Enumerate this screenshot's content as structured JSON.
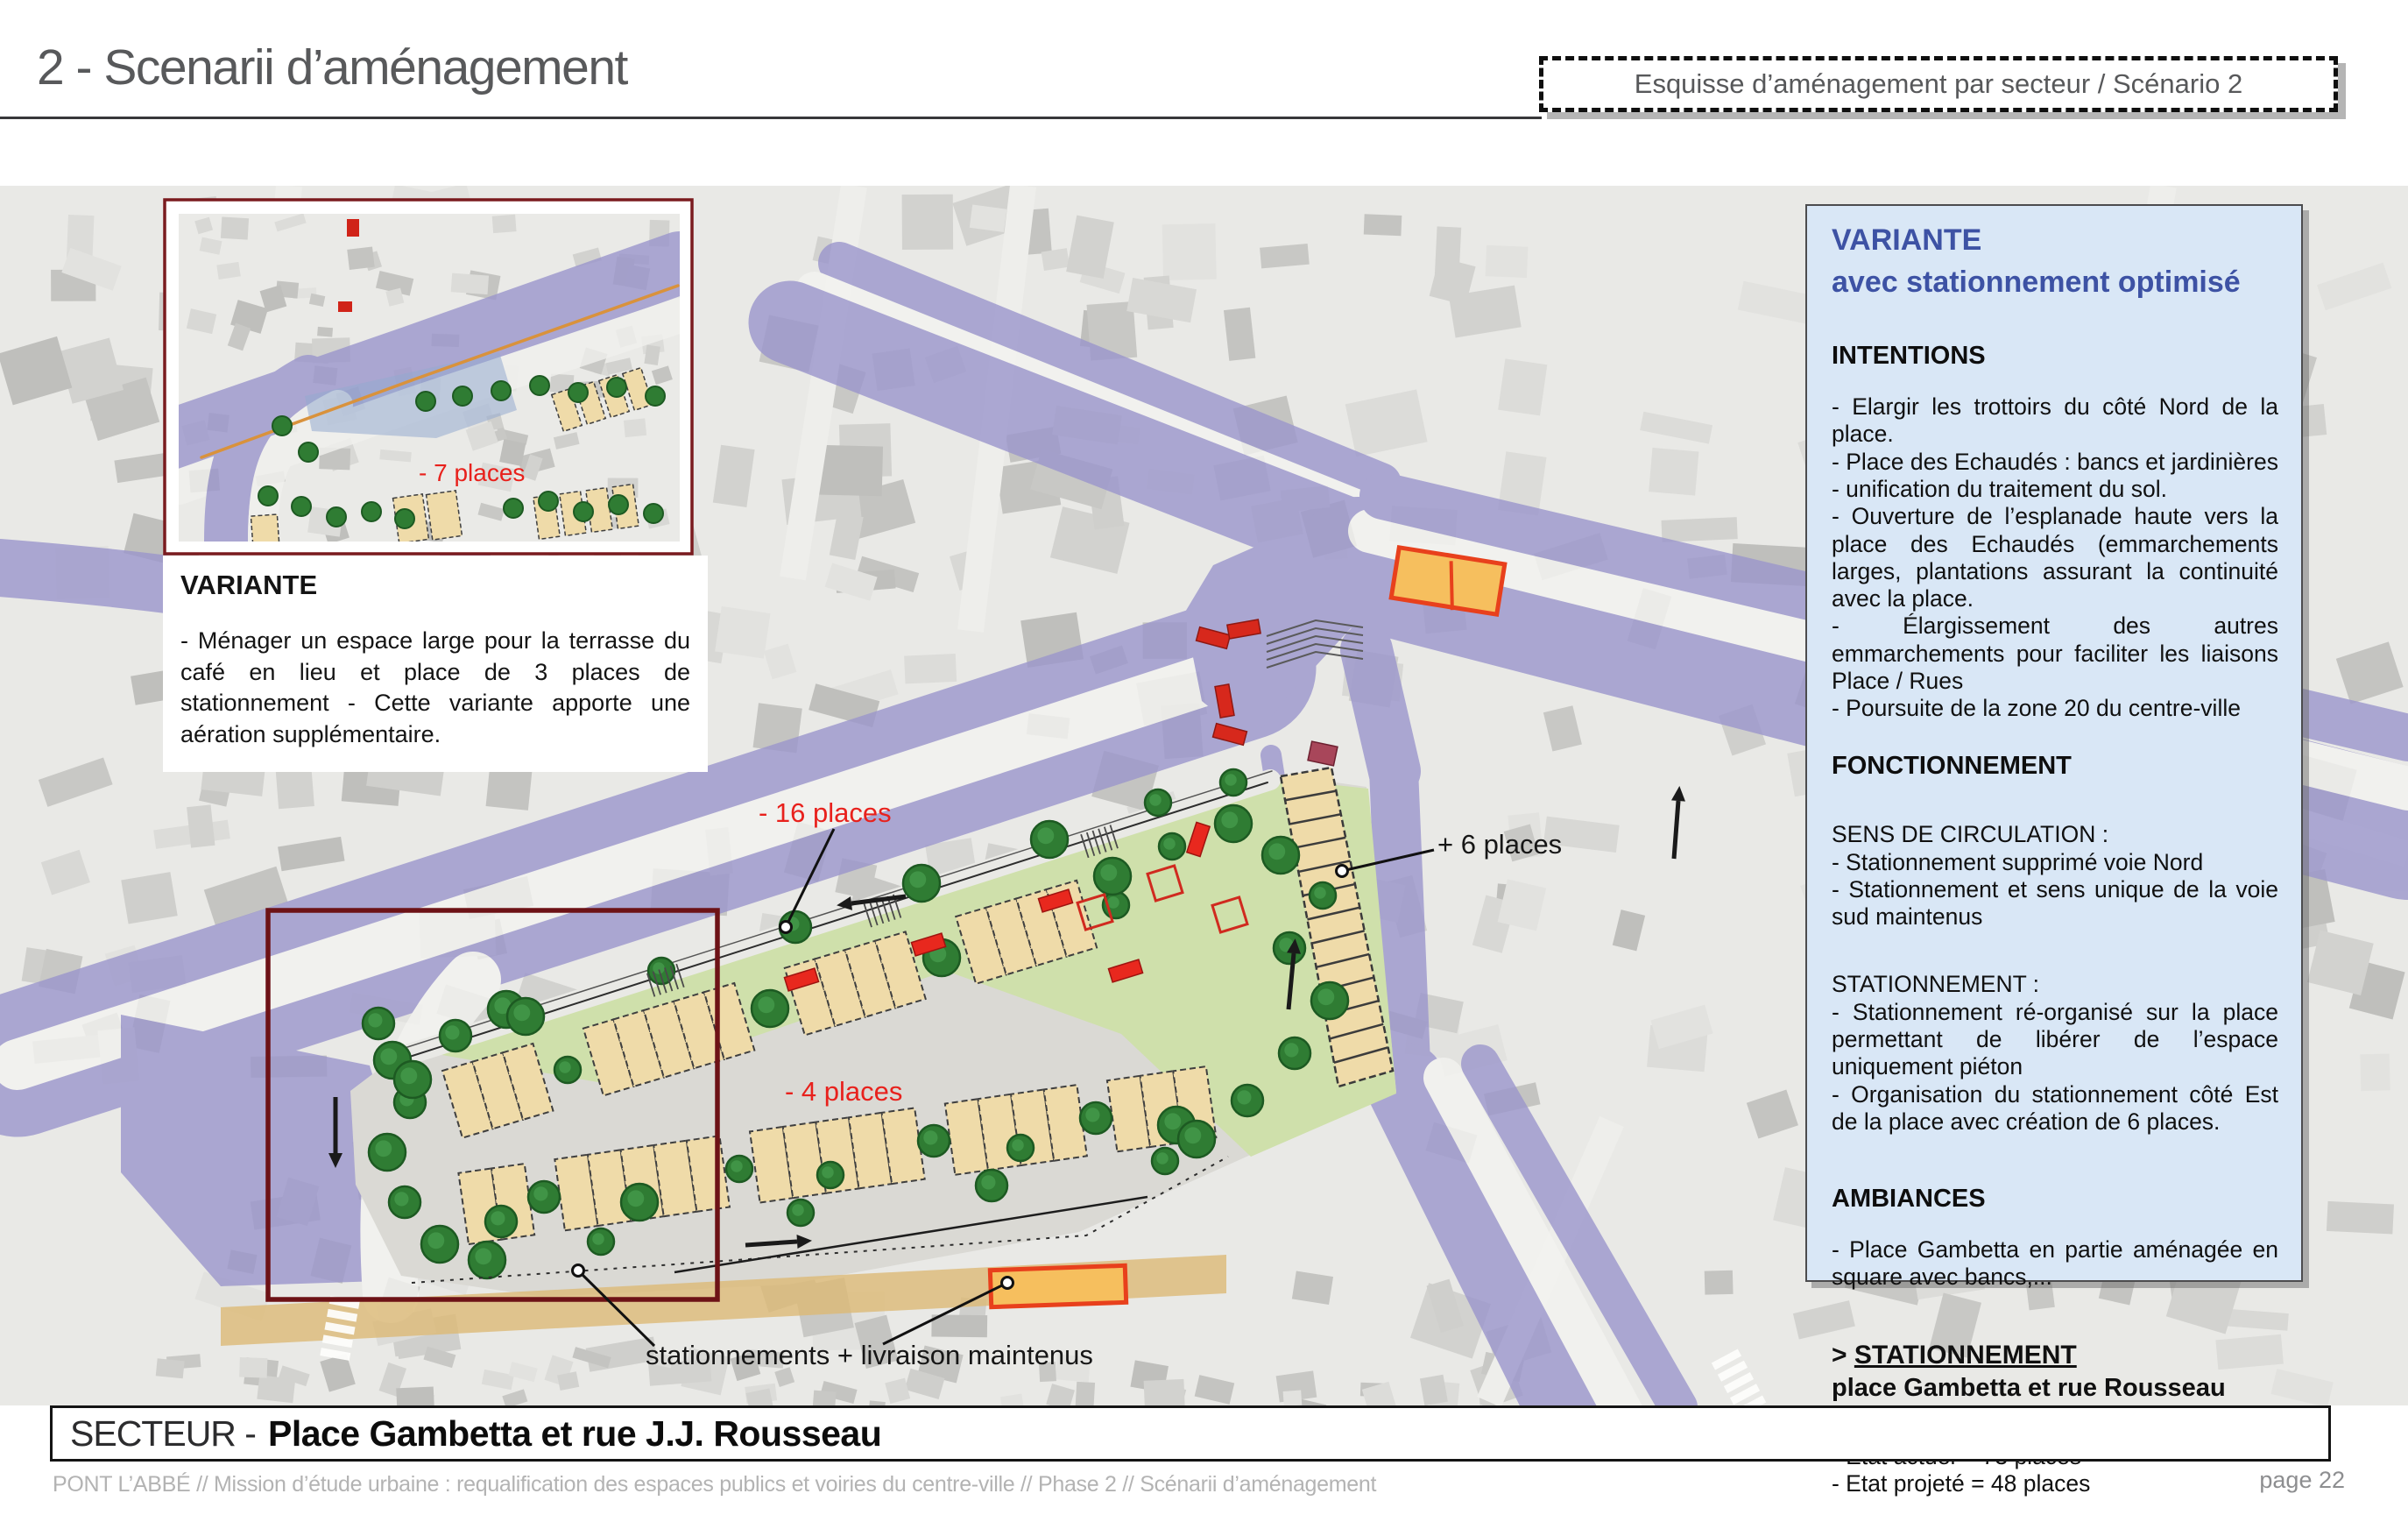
{
  "header": {
    "title": "2 - Scenarii d’aménagement",
    "scenario_box_label": "Esquisse d’aménagement par secteur / Scénario 2"
  },
  "inset": {
    "places_label": "- 7 places",
    "variante_heading": "VARIANTE",
    "variante_body": "-  Ménager un espace large pour la terrasse du café en lieu et place de 3 places de stationnement - Cette variante apporte une aération supplémentaire."
  },
  "map_labels": {
    "minus_16_places": "- 16 places",
    "plus_6_places": "+ 6 places",
    "minus_4_places": "- 4 places",
    "stationnements_maintenus": "stationnements + livraison maintenus"
  },
  "sidebar": {
    "variante_heading_line1": "VARIANTE",
    "variante_heading_line2": "avec stationnement optimisé",
    "intentions_heading": "INTENTIONS",
    "intentions_items": [
      "-  Elargir les trottoirs du côté Nord de la place.",
      "- Place des Echaudés : bancs et jardinières - unification du traitement du sol.",
      "- Ouverture de l’esplanade haute vers la place des Echaudés (emmarchements larges, plantations assurant la continuité avec la place.",
      "- Élargissement des autres emmarchements pour faciliter les liaisons Place / Rues",
      "- Poursuite de la zone 20 du centre-ville"
    ],
    "fonctionnement_heading": "FONCTIONNEMENT",
    "sens_heading": "SENS DE CIRCULATION :",
    "sens_items": [
      " - Stationnement supprimé voie Nord",
      "- Stationnement et sens unique de la voie sud maintenus"
    ],
    "stationnement_heading": "STATIONNEMENT :",
    "stationnement_items": [
      "- Stationnement ré-organisé sur la place permettant de libérer de l’espace uniquement piéton",
      "- Organisation du stationnement côté Est de la place avec création de 6 places."
    ],
    "ambiances_heading": "AMBIANCES",
    "ambiances_items": [
      "- Place Gambetta en partie aménagée en square avec bancs,..."
    ],
    "stationnement_detail_prefix": "> ",
    "stationnement_detail_heading": "STATIONNEMENT",
    "stationnement_detail_sub": "place Gambetta et rue Rousseau",
    "etat_items": [
      "- Etat actuel = 73 places",
      "- Etat projeté = 48 places"
    ]
  },
  "footer": {
    "secteur_label": "SECTEUR -",
    "secteur_name": "Place Gambetta et rue J.J. Rousseau",
    "credit": "PONT L’ABBÉ // Mission d’étude urbaine : requalification des espaces publics et voiries du centre-ville // Phase 2 // Scénarii d’aménagement",
    "page": "page 22"
  },
  "colors": {
    "accent_blue": "#3d52a4",
    "panel_blue": "#d9e7f6",
    "road_purple": "#9b96cc",
    "lawn_green": "#cfe0ab",
    "parking_beige": "#efdba9",
    "tree_green": "#2f7c33",
    "alert_red": "#e8211c",
    "zone_outline": "#6d1216",
    "livraison_orange": "#f6bf5e"
  }
}
